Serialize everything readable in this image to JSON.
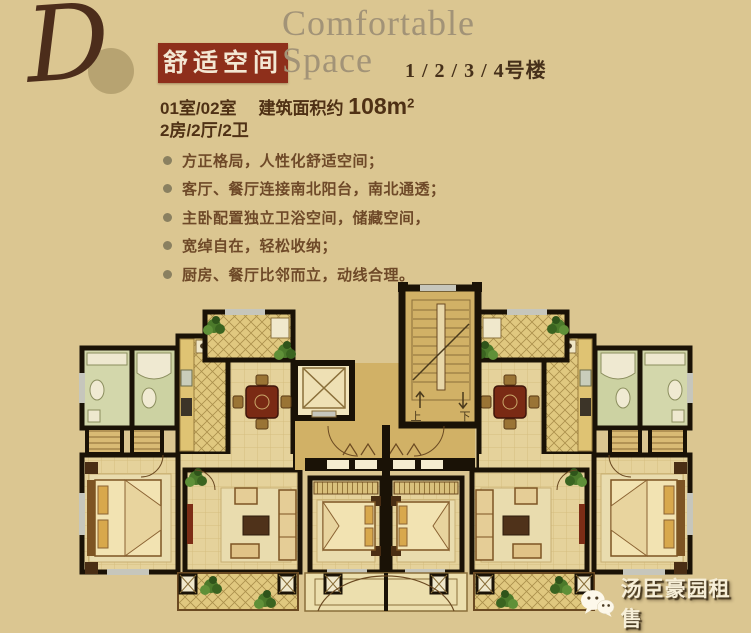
{
  "logo": {
    "letter": "D"
  },
  "header": {
    "title_cn": "舒适空间",
    "title_en_line1": "Comfortable",
    "title_en_line2": "Space",
    "buildings": "1 / 2 / 3 / 4号楼"
  },
  "summary": {
    "rooms": "01室/02室",
    "area_label": "建筑面积约",
    "area_value": "108m",
    "area_sup": "2",
    "layout": "2房/2厅/2卫"
  },
  "features": [
    "方正格局，人性化舒适空间；",
    "客厅、餐厅连接南北阳台，南北通透；",
    "主卧配置独立卫浴空间，储藏空间，",
    "宽绰自在，轻松收纳；",
    "厨房、餐厅比邻而立，动线合理。"
  ],
  "floor_plan": {
    "stairs_up_label": "上",
    "stairs_down_label": "下",
    "icons": [
      "staircase",
      "elevator",
      "dining-table",
      "bed",
      "sofa",
      "bathtub",
      "toilet",
      "plant",
      "balcony-lattice"
    ]
  },
  "watermark": {
    "icon": "wechat-icon",
    "text": "汤臣豪园租售"
  },
  "colors": {
    "background": "#dbc691",
    "accent_red": "#8e2f1b",
    "title_en": "#a29377",
    "heading_dark": "#46301a",
    "body_text": "#4f3115",
    "feature_text": "#6e4928",
    "bullet": "#8a8060",
    "wall": "#1a1206",
    "floor": "#e5d29b",
    "hall_floor": "#d1b166",
    "watermark_text": "#f7efd8"
  }
}
